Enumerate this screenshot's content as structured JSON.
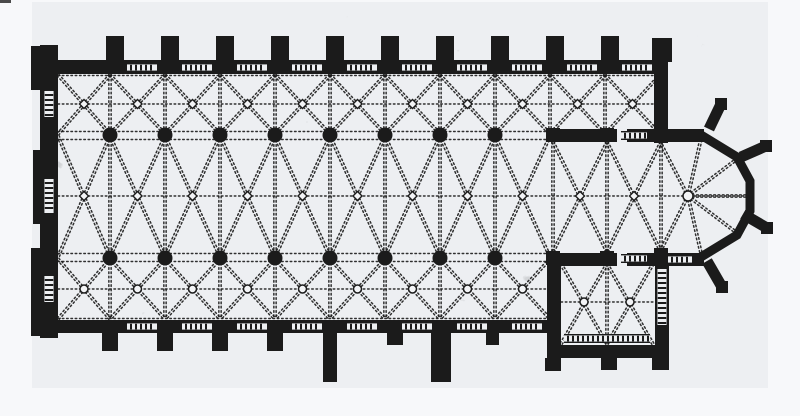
{
  "figure": {
    "kind": "scanned-floor-plan",
    "subject": "gothic-church-ground-plan"
  },
  "canvas": {
    "width": 800,
    "height": 416
  },
  "colors": {
    "ink": "#1b1b1b",
    "paper": "#f7f8fa",
    "scan_paper": "#edeff2",
    "keystone_fill": "#f3f4f6",
    "blotch": "#2a2a2a",
    "corner_mark": "#4a4a4a"
  },
  "scan": {
    "area": [
      32,
      2,
      736,
      386
    ],
    "corner_mark": [
      0,
      0,
      11,
      3
    ],
    "noise_layers": [
      {
        "filter": "blotch",
        "seed": 8,
        "rect": [
          32,
          2,
          736,
          386
        ],
        "opacity": 0.13,
        "layer": "back"
      },
      {
        "filter": "speckle",
        "seed": 3,
        "rect": [
          32,
          2,
          736,
          386
        ],
        "opacity": 0.45,
        "layer": "back"
      },
      {
        "filter": "speckle",
        "seed": 11,
        "rect": [
          36,
          28,
          668,
          354
        ],
        "opacity": 0.34,
        "layer": "front"
      },
      {
        "filter": "speckle",
        "seed": 23,
        "rect": [
          40,
          2,
          660,
          58
        ],
        "opacity": 0.3,
        "layer": "front"
      },
      {
        "filter": "speckle",
        "seed": 31,
        "rect": [
          40,
          330,
          512,
          54
        ],
        "opacity": 0.28,
        "layer": "front"
      }
    ]
  },
  "plan": {
    "walls": [
      [
        40,
        45,
        18,
        293
      ],
      [
        31,
        46,
        10,
        44
      ],
      [
        33,
        150,
        8,
        74
      ],
      [
        31,
        248,
        10,
        88
      ],
      [
        40,
        60,
        628,
        14
      ],
      [
        654,
        60,
        14,
        82
      ],
      [
        547,
        129,
        70,
        13
      ],
      [
        627,
        129,
        77,
        13
      ],
      [
        547,
        253,
        70,
        13
      ],
      [
        627,
        253,
        77,
        13
      ],
      [
        40,
        320,
        510,
        13
      ],
      [
        547,
        258,
        14,
        100
      ],
      [
        547,
        345,
        122,
        13
      ],
      [
        655,
        258,
        14,
        100
      ]
    ],
    "buttresses_north": {
      "y": 36,
      "w": 18,
      "h": 26,
      "cx": [
        115,
        170,
        225,
        280,
        335,
        390,
        445,
        500,
        555,
        610
      ]
    },
    "corner_buttress": [
      652,
      38,
      20,
      24
    ],
    "buttresses_south": [
      [
        102,
        333,
        16,
        18
      ],
      [
        157,
        333,
        16,
        18
      ],
      [
        212,
        333,
        16,
        18
      ],
      [
        267,
        333,
        16,
        18
      ],
      [
        323,
        333,
        14,
        49
      ],
      [
        387,
        333,
        16,
        12
      ],
      [
        431,
        333,
        20,
        49
      ],
      [
        486,
        333,
        13,
        12
      ],
      [
        545,
        358,
        16,
        13
      ],
      [
        601,
        358,
        16,
        12
      ],
      [
        652,
        358,
        17,
        12
      ]
    ],
    "apse": {
      "wall": [
        [
          701,
          135
        ],
        [
          737,
          157
        ],
        [
          750,
          181
        ],
        [
          750,
          211
        ],
        [
          737,
          235
        ],
        [
          701,
          257
        ]
      ],
      "wall_width": 9,
      "buttresses": [
        [
          709,
          129,
          721,
          104
        ],
        [
          741,
          157,
          766,
          146
        ],
        [
          743,
          214,
          767,
          228
        ],
        [
          707,
          261,
          722,
          287
        ]
      ],
      "center": [
        688,
        196
      ],
      "center_keystone_r": 5,
      "rays": [
        [
          660,
          142
        ],
        [
          701,
          139
        ],
        [
          737,
          159
        ],
        [
          748,
          196
        ],
        [
          737,
          233
        ],
        [
          701,
          253
        ],
        [
          660,
          252
        ]
      ]
    },
    "columns": {
      "r": 7.5,
      "rows": [
        {
          "y": 135,
          "x": [
            110,
            165,
            220,
            275,
            330,
            385,
            440,
            495
          ]
        },
        {
          "y": 258,
          "x": [
            110,
            165,
            220,
            275,
            330,
            385,
            440,
            495
          ]
        }
      ]
    },
    "piers": {
      "size": 14,
      "at": [
        [
          553,
          135
        ],
        [
          607,
          135
        ],
        [
          661,
          136
        ],
        [
          553,
          258
        ],
        [
          607,
          258
        ],
        [
          661,
          255
        ]
      ]
    },
    "vault_groups": [
      {
        "name": "nave",
        "xs": [
          58,
          110,
          165,
          220,
          275,
          330,
          385,
          440,
          495,
          550
        ],
        "y0": 136,
        "y1": 257,
        "keystone": "diamond",
        "ky": 196
      },
      {
        "name": "choir",
        "xs": [
          553,
          607,
          661
        ],
        "y0": 142,
        "y1": 252,
        "keystone": "diamond",
        "ky": 196
      },
      {
        "name": "north-aisle",
        "xs": [
          58,
          110,
          165,
          220,
          275,
          330,
          385,
          440,
          495,
          550,
          605,
          660
        ],
        "y0": 75,
        "y1": 134,
        "keystone": "diamond",
        "ky": 104
      },
      {
        "name": "south-aisle",
        "xs": [
          58,
          110,
          165,
          220,
          275,
          330,
          385,
          440,
          495,
          550
        ],
        "y0": 259,
        "y1": 319,
        "keystone": "circle",
        "ky": 289
      },
      {
        "name": "chapel",
        "xs": [
          561,
          607,
          653
        ],
        "y0": 264,
        "y1": 344,
        "keystone": "circle",
        "ky": 302
      }
    ],
    "extra_transverse": [
      [
        553,
        142,
        553,
        252
      ],
      [
        661,
        142,
        661,
        252
      ]
    ],
    "ridge_lines": [
      [
        58,
        196,
        748,
        196
      ],
      [
        58,
        104,
        654,
        104
      ],
      [
        58,
        289,
        547,
        289
      ],
      [
        561,
        302,
        653,
        302
      ]
    ],
    "arcade_lines": [
      [
        58,
        131.5,
        547,
        131.5
      ],
      [
        58,
        139.5,
        547,
        139.5
      ],
      [
        58,
        253.5,
        547,
        253.5
      ],
      [
        58,
        261.5,
        547,
        261.5
      ],
      [
        58,
        75.5,
        654,
        75.5
      ],
      [
        58,
        318.5,
        547,
        318.5
      ]
    ],
    "tracery_h": [
      [
        142,
        63,
        30
      ],
      [
        197,
        63,
        30
      ],
      [
        252,
        63,
        30
      ],
      [
        307,
        63,
        30
      ],
      [
        362,
        63,
        30
      ],
      [
        417,
        63,
        30
      ],
      [
        472,
        63,
        30
      ],
      [
        527,
        63,
        30
      ],
      [
        582,
        63,
        30
      ],
      [
        637,
        63,
        30
      ],
      [
        634,
        131,
        26
      ],
      [
        634,
        254,
        26
      ],
      [
        680,
        255,
        24
      ],
      [
        142,
        322,
        30
      ],
      [
        197,
        322,
        30
      ],
      [
        252,
        322,
        30
      ],
      [
        307,
        322,
        30
      ],
      [
        362,
        322,
        30
      ],
      [
        417,
        322,
        30
      ],
      [
        472,
        322,
        30
      ],
      [
        527,
        322,
        30
      ],
      [
        607,
        334,
        86
      ]
    ],
    "tracery_v": [
      [
        43,
        104,
        26
      ],
      [
        43,
        196,
        34
      ],
      [
        43,
        289,
        26
      ],
      [
        656,
        297,
        56
      ]
    ]
  }
}
